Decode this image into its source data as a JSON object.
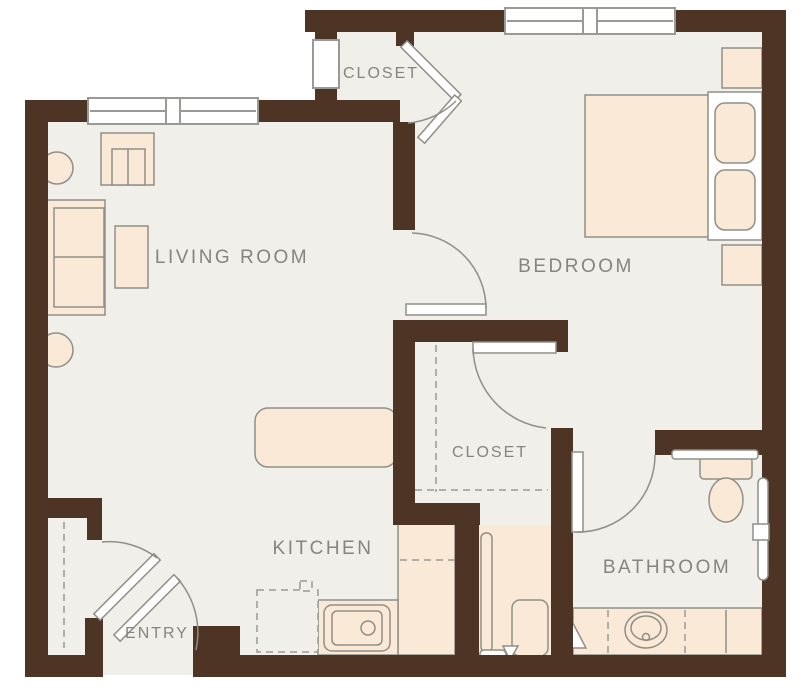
{
  "title": "One-bedroom apartment floor plan",
  "colors": {
    "wall": "#4d3425",
    "floor": "#f1efe9",
    "furniture": "#f9e9d6",
    "outline": "#8f8f88",
    "window_frame": "#9a9a94",
    "dashed": "#9a9a92",
    "label": "#85857d"
  },
  "rooms": {
    "living_room": {
      "label": "LIVING ROOM"
    },
    "bedroom": {
      "label": "BEDROOM"
    },
    "kitchen": {
      "label": "KITCHEN"
    },
    "bathroom": {
      "label": "BATHROOM"
    },
    "entry": {
      "label": "ENTRY"
    },
    "closet_top": {
      "label": "CLOSET"
    },
    "closet_middle": {
      "label": "CLOSET"
    }
  },
  "fixtures": [
    "sofa",
    "armchair",
    "tv-cabinet",
    "side-table",
    "side-table",
    "bed",
    "headboard-pillows",
    "nightstand",
    "nightstand",
    "kitchen-peninsula",
    "kitchen-counter",
    "kitchen-sink",
    "dishwasher",
    "washer-dryer",
    "utility-shelf",
    "bathroom-vanity",
    "bathroom-sink",
    "toilet",
    "grab-bar",
    "towel-bar",
    "window",
    "window",
    "window",
    "door-swing-bedroom",
    "door-swing-bathroom",
    "door-swing-closet",
    "bifold-closet-door",
    "entry-door",
    "entry-closet-door"
  ]
}
